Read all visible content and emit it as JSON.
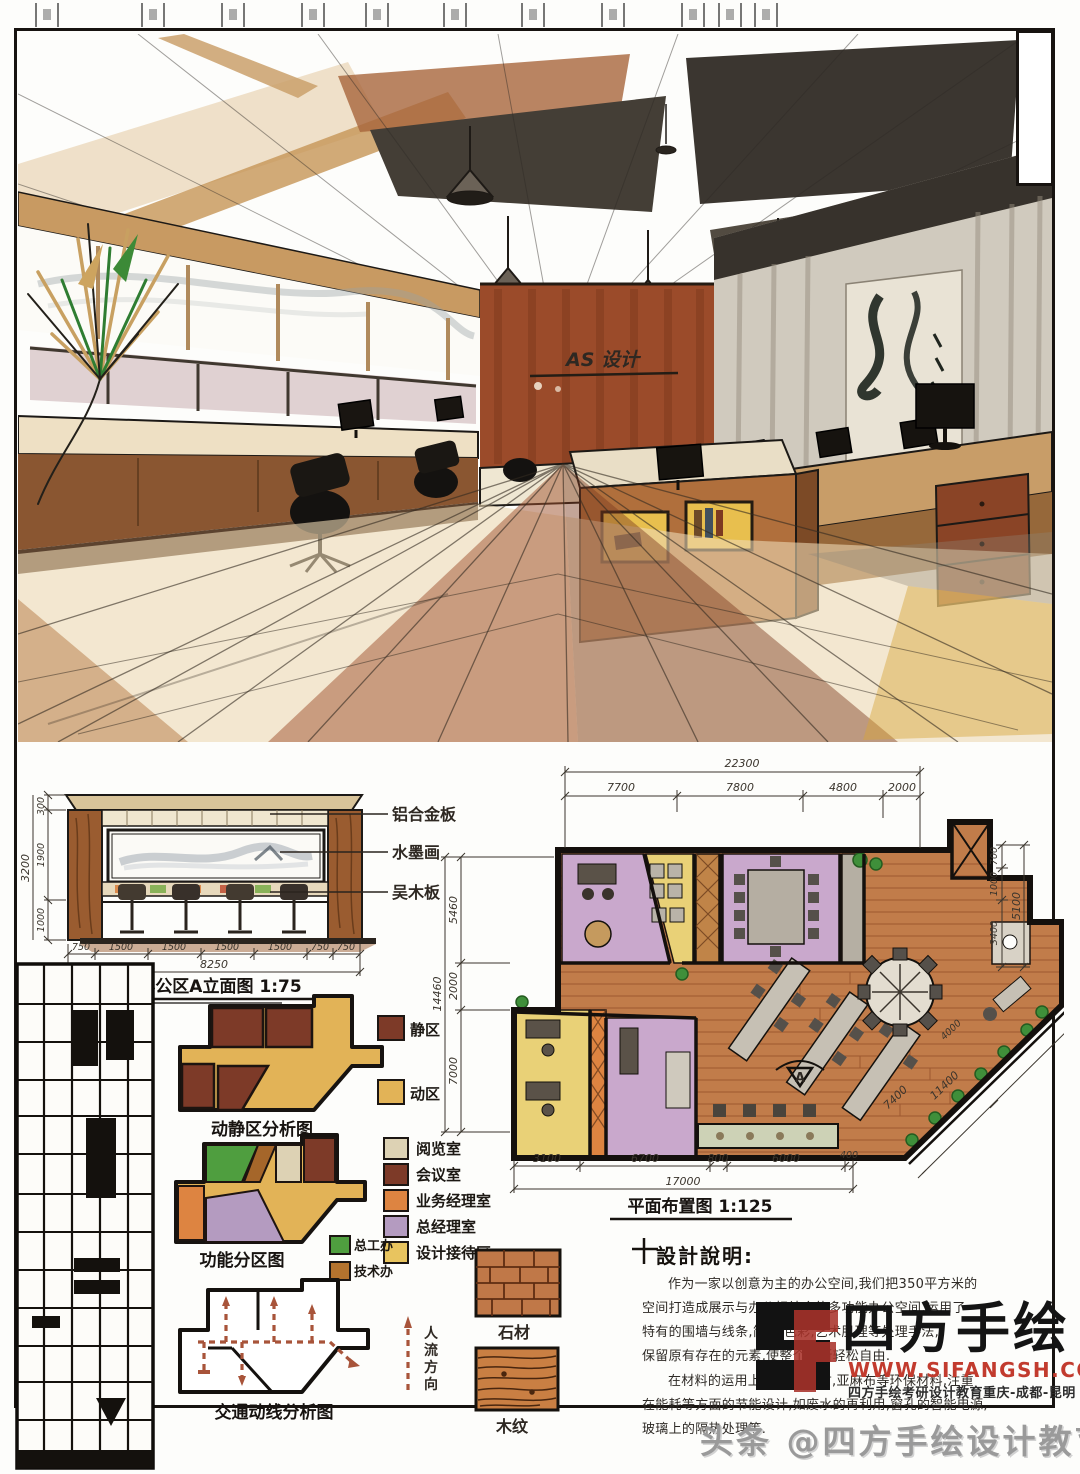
{
  "board": {
    "perspective": {
      "wall_logo": "AS 设计"
    },
    "elevation": {
      "title": "办公区A立面图 1:75",
      "callouts": [
        "铝合金板",
        "水墨画",
        "吴木板"
      ],
      "v_dims": [
        "300",
        "1900",
        "1000"
      ],
      "v_total": "3200",
      "h_dims": [
        "750",
        "1500",
        "1500",
        "1500",
        "1500",
        "750",
        "750"
      ],
      "h_total": "8250"
    },
    "floor_plan": {
      "title": "平面布置图 1:125",
      "top_dims": [
        "7700",
        "7800",
        "4800",
        "2000"
      ],
      "top_total": "22300",
      "left_dims": [
        "5460",
        "2000",
        "7000"
      ],
      "left_total": "14460",
      "bottom_dims": [
        "3100",
        "6700",
        "800",
        "6000",
        "400"
      ],
      "bottom_total": "17000",
      "right_dims": [
        "700",
        "1000",
        "3400"
      ],
      "right_total": "5100",
      "diag_dims": [
        "4000",
        "11400",
        "7400"
      ],
      "section_marker": "A"
    },
    "diagrams": {
      "zoning": {
        "title": "动静区分析图",
        "legend": [
          {
            "label": "静区",
            "color": "#7d3a28"
          },
          {
            "label": "动区",
            "color": "#e2b357"
          }
        ]
      },
      "function": {
        "title": "功能分区图",
        "legend": [
          {
            "label": "阅览室",
            "color": "#ddd2b4"
          },
          {
            "label": "会议室",
            "color": "#7d3a28"
          },
          {
            "label": "业务经理室",
            "color": "#dd8441"
          },
          {
            "label": "总经理室",
            "color": "#b49bc0"
          },
          {
            "label": "设计接待区",
            "color": "#e8c45f"
          }
        ],
        "legend_extra": [
          {
            "label": "总工办",
            "color": "#4f9e3f"
          },
          {
            "label": "技术办",
            "color": "#b4732e"
          }
        ]
      },
      "circulation": {
        "title": "交通动线分析图",
        "flow_chars": [
          "人",
          "流",
          "方",
          "向"
        ]
      }
    },
    "materials": [
      {
        "label": "石材"
      },
      {
        "label": "木纹"
      }
    ],
    "notes": {
      "title": "設計說明:",
      "lines": [
        "作为一家以创意为主的办公空间,我们把350平方米的",
        "空间打造成展示与办公相结合的多功能办公空间,运用了",
        "特有的围墙与线条,简洁,色彩,艺术肌理等处理手法,",
        "保留原有存在的元素,使整个场所轻松自由.",
        "在材料的运用上以石材,木材,亚麻布等环保材料,注重",
        "在能耗等方面的节能设计,如废水的再利用,窗孔的智能电源,",
        "玻璃上的隔热处理等."
      ]
    },
    "watermark": {
      "brand": "四方手绘",
      "url": "WWW.SIFANGSH.COM",
      "tagline": "四方手绘考研设计教育重庆-成都-昆明",
      "footer": "头条 @四方手绘设计教育"
    }
  }
}
